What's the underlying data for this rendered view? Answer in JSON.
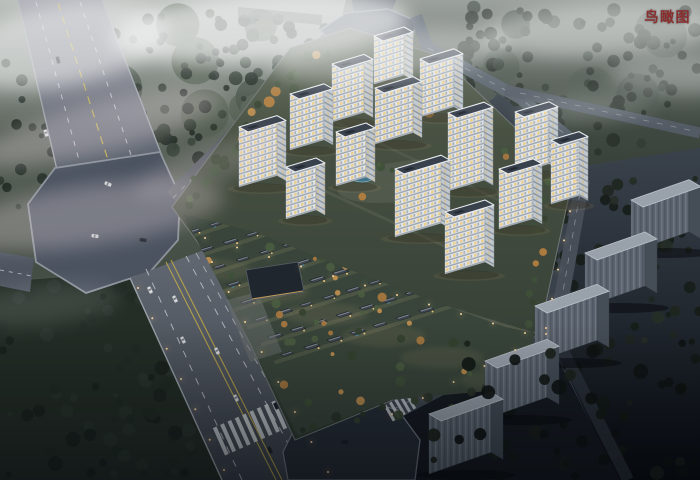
{
  "annotation": {
    "label": "鸟瞰图",
    "color": "#8a2e2e"
  },
  "scene": {
    "palette": {
      "fog": "#f1f3f3",
      "fog_pink": "#e9dce1",
      "tower_facade": "#e3e7ea",
      "tower_roof": "#39414d",
      "window_lit": "#edc97e",
      "road": "#565e69",
      "lane_yellow": "#c2ae52",
      "lane_white": "#ced2d6",
      "greenery": "#3c4838",
      "autumn_tree": "#b07f43",
      "context_building": "#5b636e",
      "night_ground": "#10151a",
      "pool_water": "#43748a",
      "lamp_glow": "#ffd9a0"
    },
    "towers": [
      [
        374,
        84,
        30,
        48
      ],
      [
        420,
        117,
        34,
        58
      ],
      [
        332,
        122,
        32,
        58
      ],
      [
        375,
        144,
        38,
        56
      ],
      [
        290,
        150,
        34,
        56
      ],
      [
        515,
        174,
        34,
        62
      ],
      [
        336,
        186,
        30,
        54
      ],
      [
        239,
        187,
        38,
        60
      ],
      [
        448,
        191,
        36,
        78
      ],
      [
        551,
        204,
        28,
        64
      ],
      [
        286,
        219,
        30,
        52
      ],
      [
        499,
        229,
        34,
        60
      ],
      [
        395,
        237,
        46,
        68
      ],
      [
        445,
        274,
        40,
        62
      ]
    ],
    "context_buildings": [
      [
        631,
        252,
        58,
        52
      ],
      [
        585,
        307,
        60,
        54
      ],
      [
        535,
        362,
        62,
        56
      ],
      [
        485,
        419,
        62,
        58
      ],
      [
        429,
        474,
        62,
        60
      ]
    ],
    "pools": [
      {
        "cx": 362,
        "cy": 176,
        "rx": 12,
        "ry": 6
      },
      {
        "cx": 448,
        "cy": 179,
        "rx": 14,
        "ry": 7
      }
    ],
    "cars": [
      {
        "x": 46,
        "y": 133,
        "a": 73,
        "c": "#d9dbdd"
      },
      {
        "x": 58,
        "y": 60,
        "a": 73,
        "c": "#272c31"
      },
      {
        "x": 95,
        "y": 236,
        "a": 8,
        "c": "#c9cdd1"
      },
      {
        "x": 143,
        "y": 240,
        "a": 8,
        "c": "#23282e"
      },
      {
        "x": 108,
        "y": 184,
        "a": 22,
        "c": "#d2d5d8"
      },
      {
        "x": 150,
        "y": 290,
        "a": 64,
        "c": "#d7d9db"
      },
      {
        "x": 175,
        "y": 299,
        "a": 64,
        "c": "#d1d4d7"
      },
      {
        "x": 183,
        "y": 340,
        "a": 64,
        "c": "#cacdd1"
      },
      {
        "x": 217,
        "y": 351,
        "a": 64,
        "c": "#d4d6d9"
      },
      {
        "x": 236,
        "y": 398,
        "a": 64,
        "c": "#d0d3d6"
      },
      {
        "x": 276,
        "y": 406,
        "a": 64,
        "c": "#1e242a"
      },
      {
        "x": 270,
        "y": 450,
        "a": 64,
        "c": "#22272d"
      },
      {
        "x": 345,
        "y": 442,
        "a": 5,
        "c": "#1c2127"
      }
    ],
    "clouds": [
      {
        "cx": 60,
        "cy": 45,
        "rx": 110,
        "ry": 40,
        "o": 0.55,
        "rot": -10
      },
      {
        "cx": 260,
        "cy": 28,
        "rx": 150,
        "ry": 34,
        "o": 0.7,
        "rot": -4
      },
      {
        "cx": 390,
        "cy": 55,
        "rx": 120,
        "ry": 24,
        "o": 0.4,
        "rot": -6
      },
      {
        "cx": 600,
        "cy": 30,
        "rx": 120,
        "ry": 26,
        "o": 0.45,
        "rot": -3
      },
      {
        "cx": 685,
        "cy": 75,
        "rx": 75,
        "ry": 20,
        "o": 0.3,
        "rot": 0
      },
      {
        "cx": 100,
        "cy": 128,
        "rx": 125,
        "ry": 24,
        "o": 0.3,
        "rot": -14,
        "c": "#ecdfe3"
      },
      {
        "cx": 90,
        "cy": 215,
        "rx": 135,
        "ry": 30,
        "o": 0.3,
        "rot": -8,
        "c": "#e8dadf"
      },
      {
        "cx": 210,
        "cy": 165,
        "rx": 80,
        "ry": 18,
        "o": 0.2,
        "rot": -20,
        "c": "#e8dadf"
      },
      {
        "cx": 585,
        "cy": 108,
        "rx": 70,
        "ry": 14,
        "o": 0.2,
        "rot": -4
      },
      {
        "cx": 40,
        "cy": 305,
        "rx": 80,
        "ry": 20,
        "o": 0.12,
        "rot": -6
      }
    ]
  }
}
